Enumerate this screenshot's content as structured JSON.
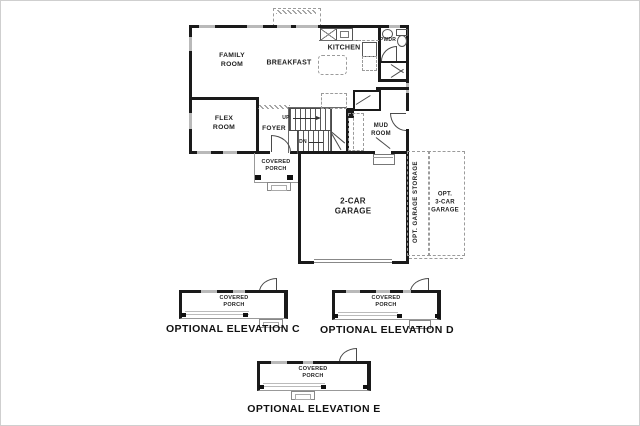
{
  "plan": {
    "family_room": "FAMILY\nROOM",
    "breakfast": "BREAKFAST",
    "kitchen": "KITCHEN",
    "pwdr": "PWDR",
    "flex_room": "FLEX\nROOM",
    "foyer": "FOYER",
    "mud_room": "MUD\nROOM",
    "covered_porch": "COVERED\nPORCH",
    "garage": "2-CAR\nGARAGE",
    "opt_garage_storage": "OPT. GARAGE STORAGE",
    "opt_3car_garage": "OPT.\n3-CAR\nGARAGE",
    "up": "UP",
    "dn": "DN"
  },
  "elevations": [
    {
      "title": "OPTIONAL ELEVATION C",
      "porch": "COVERED\nPORCH"
    },
    {
      "title": "OPTIONAL ELEVATION D",
      "porch": "COVERED\nPORCH"
    },
    {
      "title": "OPTIONAL ELEVATION E",
      "porch": "COVERED\nPORCH"
    }
  ],
  "colors": {
    "wall": "#1a1a1a",
    "window": "#b9b9b9",
    "dashed_line": "#9b9b9b",
    "text": "#222222"
  }
}
